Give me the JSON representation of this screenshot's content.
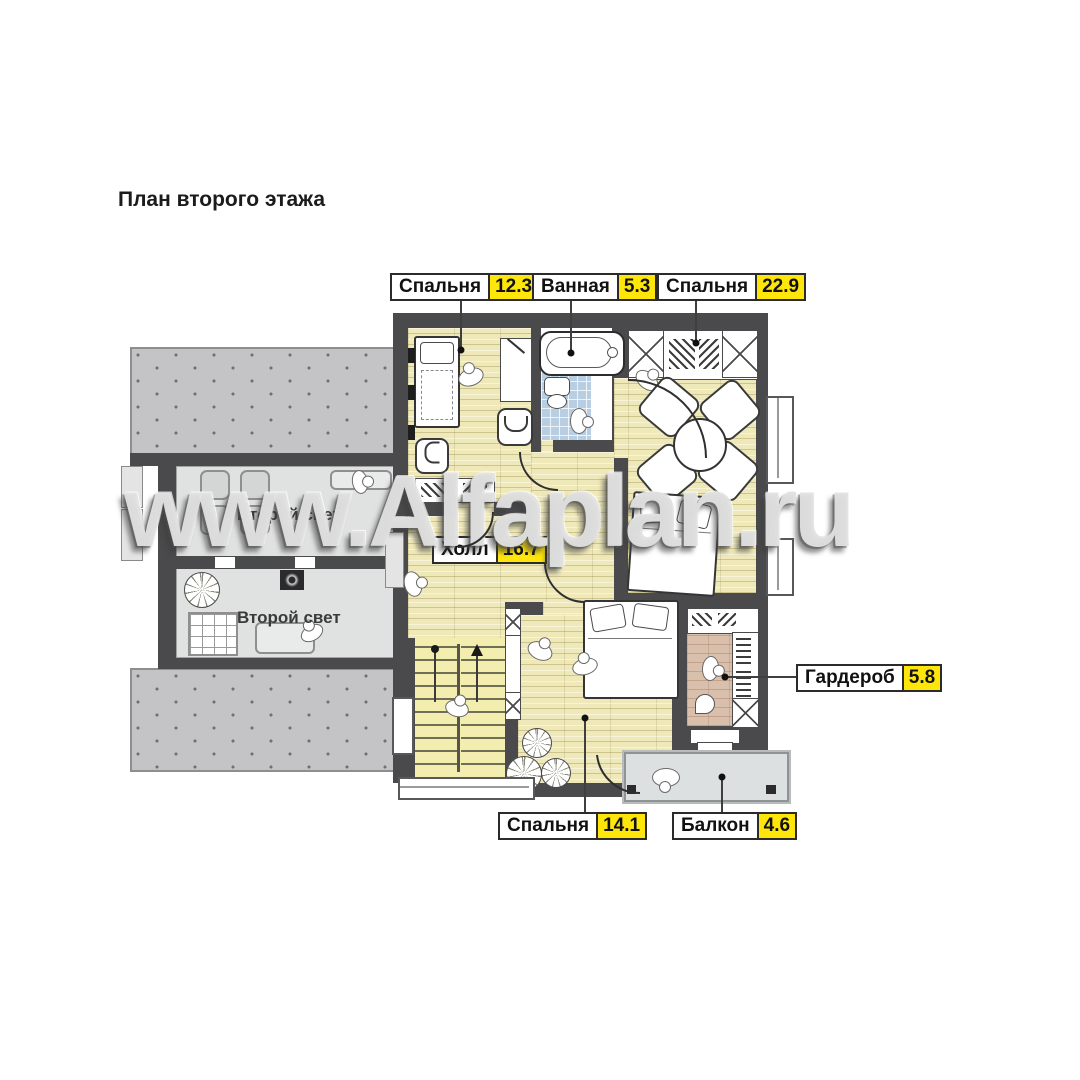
{
  "title": "План второго этажа",
  "watermark": "www.Alfaplan.ru",
  "room_labels": {
    "bedroom_top_left": {
      "name": "Спальня",
      "area": "12.3"
    },
    "bathroom": {
      "name": "Ванная",
      "area": "5.3"
    },
    "bedroom_top_right": {
      "name": "Спальня",
      "area": "22.9"
    },
    "hall": {
      "name": "Холл",
      "area": "16.7"
    },
    "bedroom_bottom": {
      "name": "Спальня",
      "area": "14.1"
    },
    "balcony": {
      "name": "Балкон",
      "area": "4.6"
    },
    "wardrobe": {
      "name": "Гардероб",
      "area": "5.8"
    }
  },
  "area_labels": {
    "second_light_upper": "Второй свет",
    "second_light_lower": "Второй свет"
  },
  "colors": {
    "accent_yellow": "#ffe60a",
    "wall": "#4a4a4c",
    "wood_floor": "#efe9ba",
    "tile_floor": "#b7cee3",
    "wardrobe_floor": "#d9c0ad",
    "roof_hatch": "#c4c4c6",
    "second_light_floor": "#e0e1e1",
    "balcony_floor": "#dde0e1"
  }
}
